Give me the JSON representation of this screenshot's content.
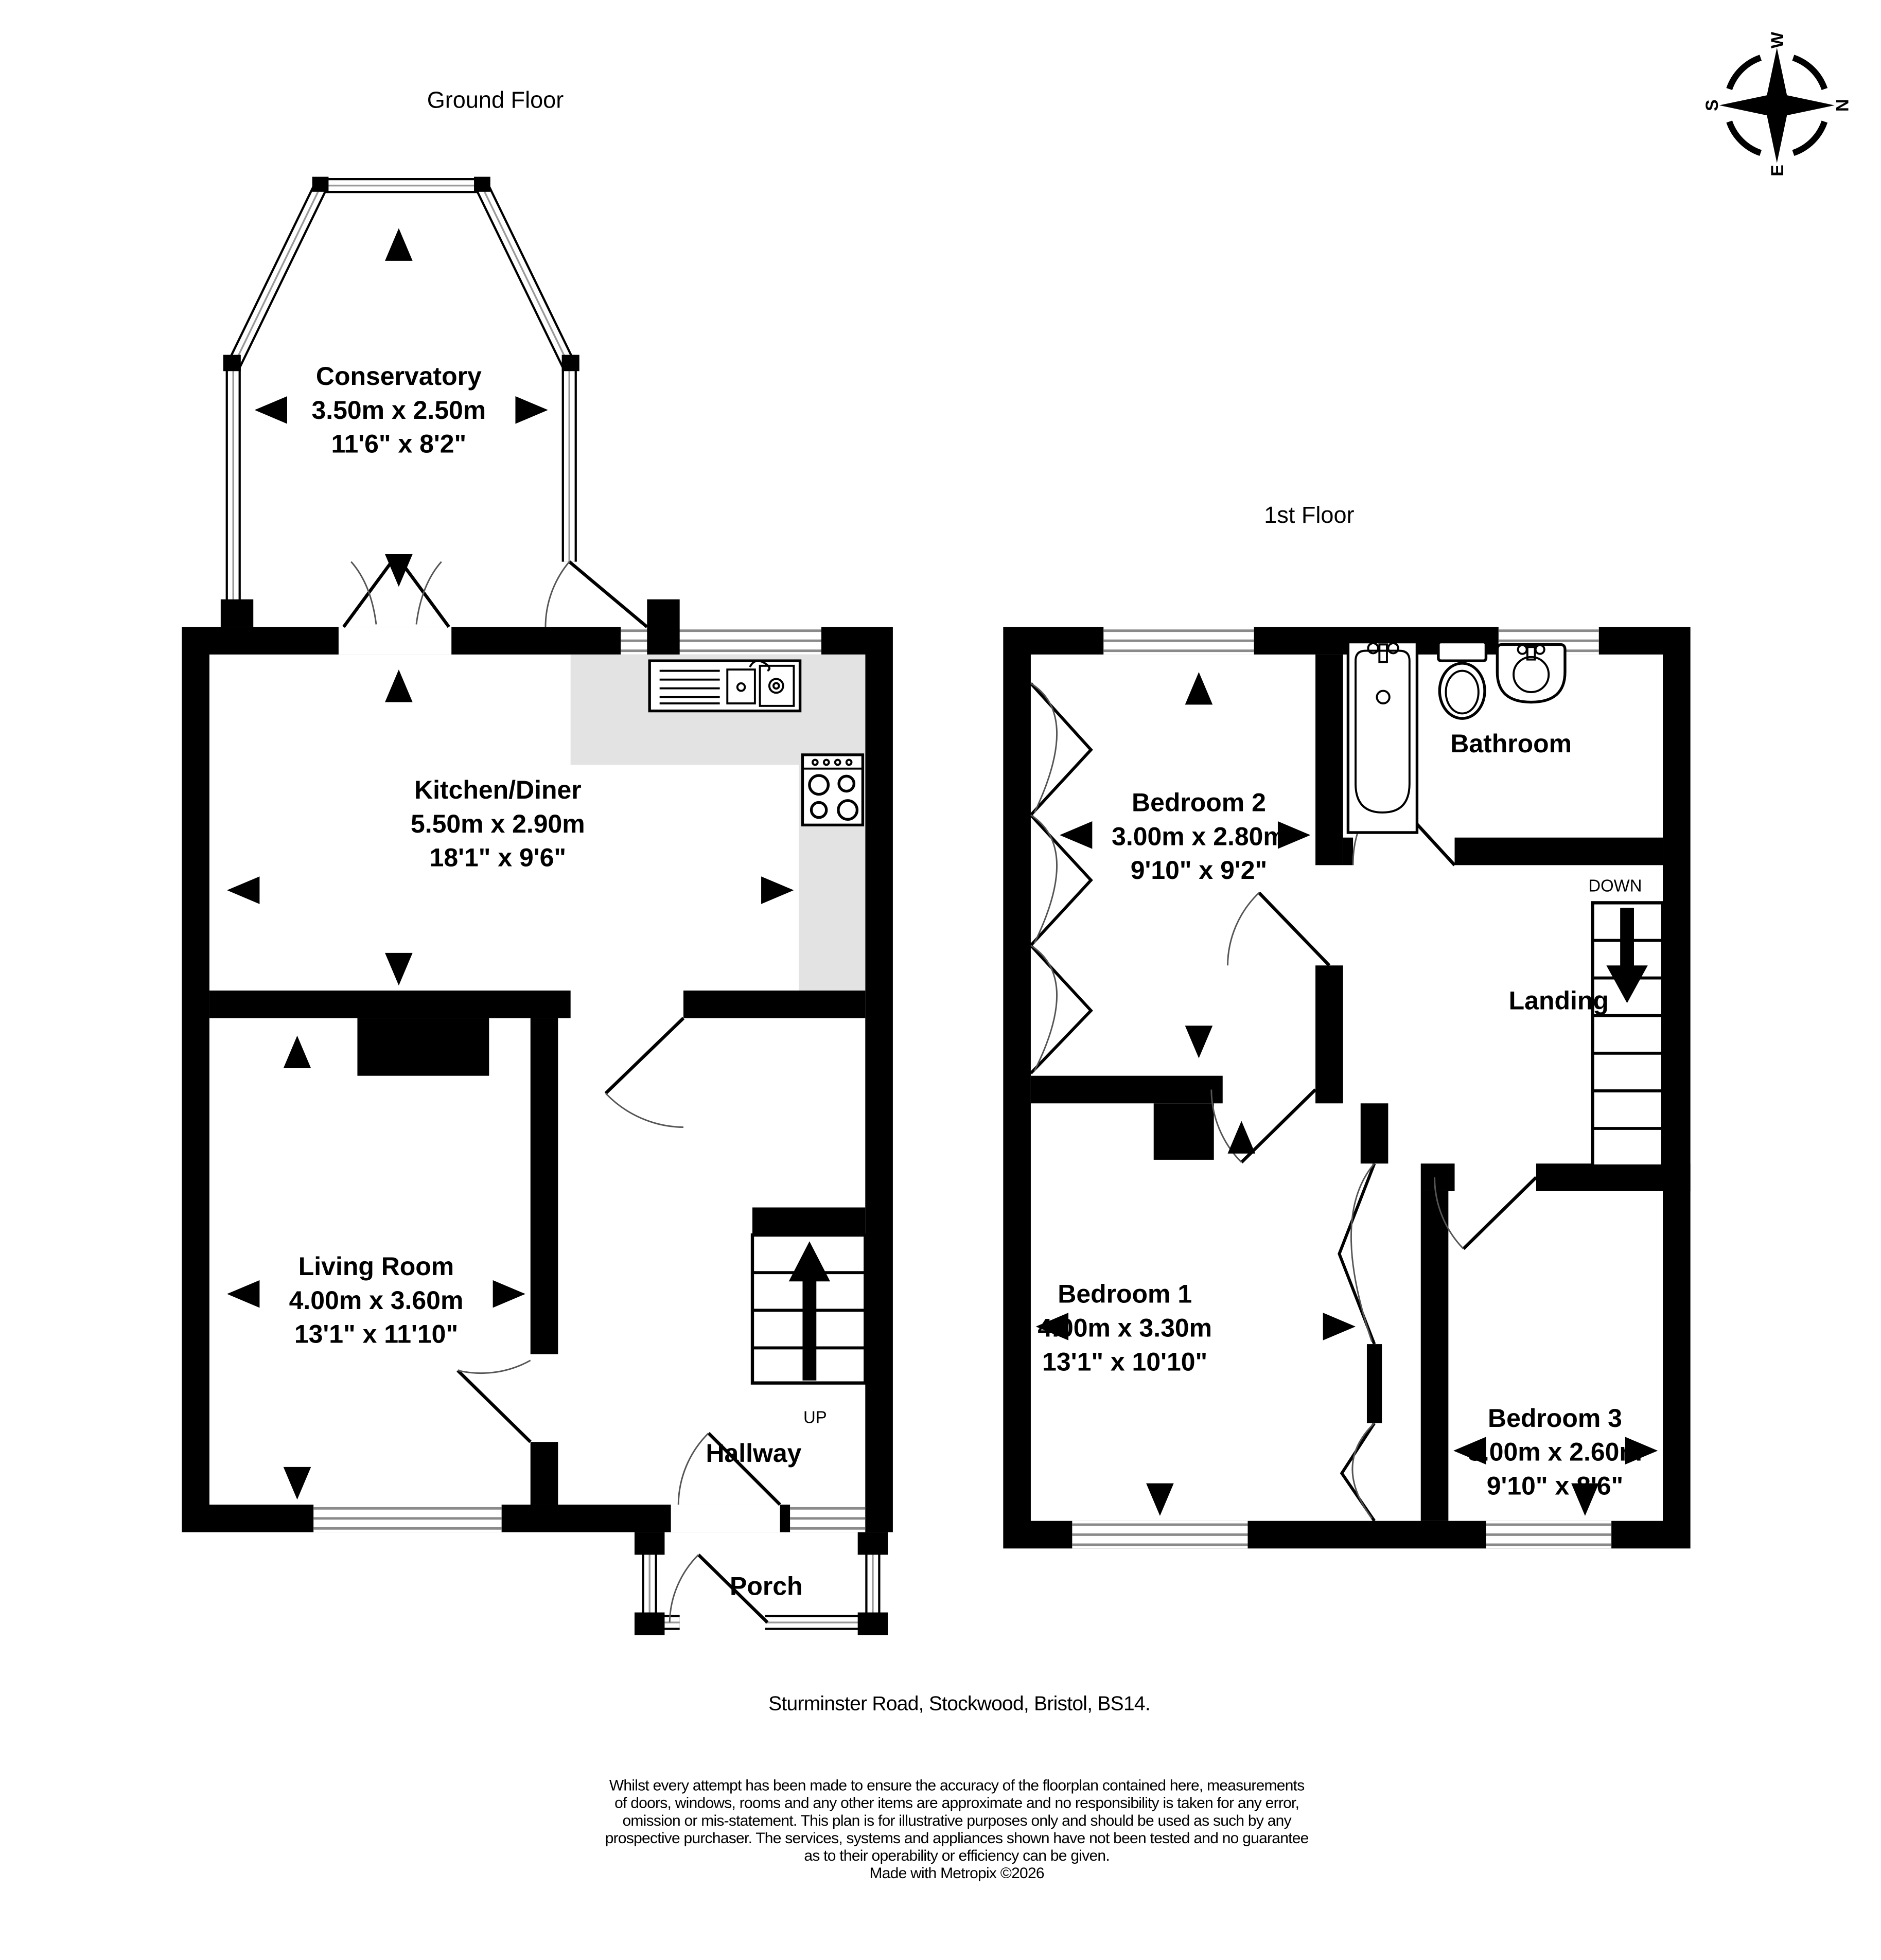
{
  "floors": {
    "ground": {
      "label": "Ground Floor",
      "stairs_direction": "UP",
      "rooms": {
        "conservatory": {
          "name": "Conservatory",
          "metric": "3.50m x 2.50m",
          "imperial": "11'6\" x 8'2\""
        },
        "kitchen_diner": {
          "name": "Kitchen/Diner",
          "metric": "5.50m x 2.90m",
          "imperial": "18'1\" x 9'6\""
        },
        "living_room": {
          "name": "Living Room",
          "metric": "4.00m x 3.60m",
          "imperial": "13'1\" x 11'10\""
        },
        "hallway": {
          "name": "Hallway"
        },
        "porch": {
          "name": "Porch"
        }
      }
    },
    "first": {
      "label": "1st Floor",
      "stairs_direction": "DOWN",
      "rooms": {
        "bedroom_2": {
          "name": "Bedroom 2",
          "metric": "3.00m x 2.80m",
          "imperial": "9'10\" x 9'2\""
        },
        "bathroom": {
          "name": "Bathroom"
        },
        "landing": {
          "name": "Landing"
        },
        "bedroom_1": {
          "name": "Bedroom 1",
          "metric": "4.00m x 3.30m",
          "imperial": "13'1\" x 10'10\""
        },
        "bedroom_3": {
          "name": "Bedroom 3",
          "metric": "3.00m x 2.60m",
          "imperial": "9'10\" x 8'6\""
        }
      }
    }
  },
  "compass": {
    "north": "N",
    "east": "E",
    "south": "S",
    "west": "W"
  },
  "footer": {
    "address": "Sturminster Road, Stockwood, Bristol, BS14.",
    "disclaimer_lines": [
      "Whilst every attempt has been made to ensure the accuracy of the floorplan contained here, measurements",
      "of doors, windows, rooms and any other items are approximate and no responsibility is taken for any error,",
      "omission or mis-statement. This plan is for illustrative purposes only and should be used as such by any",
      "prospective purchaser. The services, systems and appliances shown have not been tested and no guarantee",
      "as to their operability or efficiency can be given."
    ],
    "credit": "Made with Metropix ©2026"
  }
}
